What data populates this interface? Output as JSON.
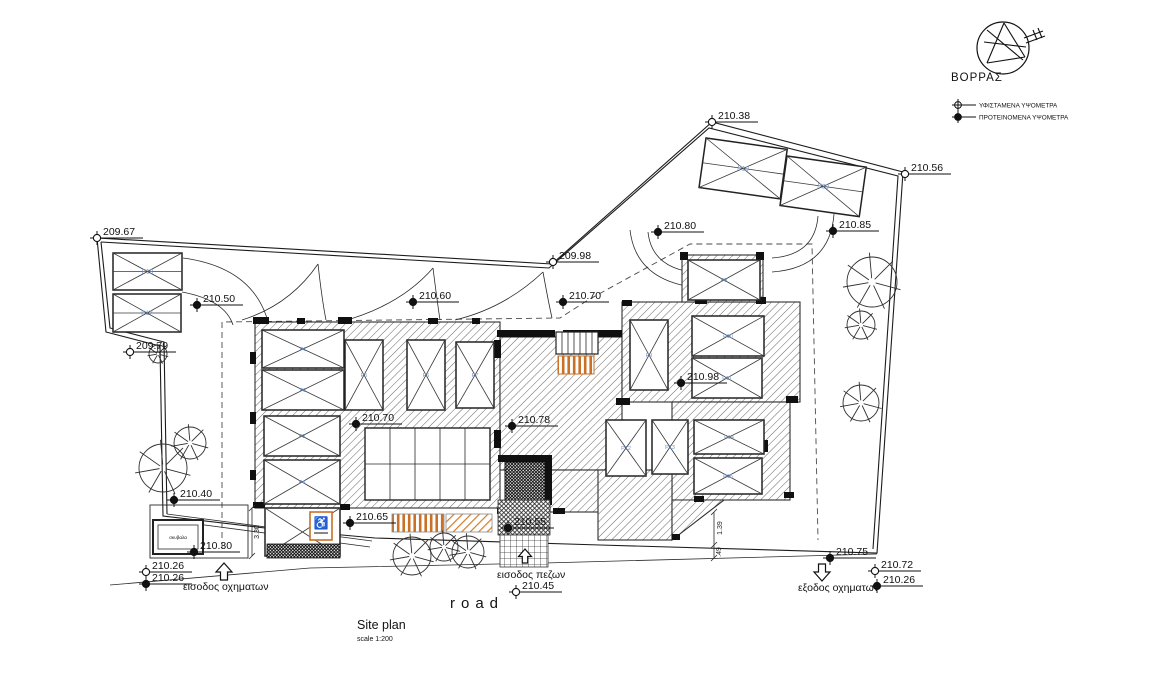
{
  "canvas": {
    "background": "#ffffff",
    "ink": "#1c1c1c",
    "parking_label_blue": "#6b93cf",
    "ramp_orange": "#c87127"
  },
  "title": {
    "name": "Site plan",
    "scale": "scale 1:200"
  },
  "road_label": "road",
  "compass_label": "ΒΟΡΡΑΣ",
  "legend": {
    "existing": "ΥΦΙΣΤΑΜΕΝΑ ΥΨΟΜΕΤΡΑ",
    "proposed": "ΠΡΟΤΕΙΝΟΜΕΝΑ ΥΨΟΜΕΤΡΑ"
  },
  "annotations": {
    "vehicle_entrance": "εισοδος οχηματων",
    "pedestrian_entrance": "εισοδος πεζων",
    "vehicle_exit": "εξοδος οχηματων",
    "bin": "σκυβαλα",
    "accessible_symbol": "♿"
  },
  "elevations": [
    {
      "value": "209.67",
      "type": "existing",
      "x": 97,
      "y": 238
    },
    {
      "value": "210.38",
      "type": "existing",
      "x": 712,
      "y": 122
    },
    {
      "value": "210.56",
      "type": "existing",
      "x": 905,
      "y": 174
    },
    {
      "value": "209.98",
      "type": "existing",
      "x": 553,
      "y": 262
    },
    {
      "value": "210.80",
      "type": "proposed",
      "x": 658,
      "y": 232
    },
    {
      "value": "210.85",
      "type": "proposed",
      "x": 833,
      "y": 231
    },
    {
      "value": "210.50",
      "type": "proposed",
      "x": 197,
      "y": 305
    },
    {
      "value": "210.60",
      "type": "proposed",
      "x": 413,
      "y": 302
    },
    {
      "value": "210.70",
      "type": "proposed",
      "x": 563,
      "y": 302
    },
    {
      "value": "209.79",
      "type": "existing",
      "x": 130,
      "y": 352
    },
    {
      "value": "210.70",
      "type": "proposed",
      "x": 356,
      "y": 424
    },
    {
      "value": "210.78",
      "type": "proposed",
      "x": 512,
      "y": 426
    },
    {
      "value": "210.98",
      "type": "proposed",
      "x": 681,
      "y": 383
    },
    {
      "value": "210.40",
      "type": "proposed",
      "x": 174,
      "y": 500
    },
    {
      "value": "210.30",
      "type": "proposed",
      "x": 194,
      "y": 552
    },
    {
      "value": "210.26",
      "type": "existing",
      "x": 146,
      "y": 572
    },
    {
      "value": "210.26",
      "type": "proposed",
      "x": 146,
      "y": 584
    },
    {
      "value": "210.65",
      "type": "proposed",
      "x": 350,
      "y": 523
    },
    {
      "value": "210.55",
      "type": "proposed",
      "x": 508,
      "y": 528
    },
    {
      "value": "210.45",
      "type": "existing",
      "x": 516,
      "y": 592
    },
    {
      "value": "210.75",
      "type": "proposed",
      "x": 830,
      "y": 558
    },
    {
      "value": "210.72",
      "type": "existing",
      "x": 875,
      "y": 571
    },
    {
      "value": "210.26",
      "type": "proposed",
      "x": 877,
      "y": 586
    }
  ],
  "dimensions": [
    {
      "value": "3.30",
      "x": 259,
      "y": 532
    },
    {
      "value": "1.39",
      "x": 722,
      "y": 528
    },
    {
      "value": ".49",
      "x": 721,
      "y": 552
    }
  ],
  "parking": {
    "exterior": [
      {
        "label": "P18",
        "x": 113,
        "y": 253,
        "w": 69,
        "h": 37,
        "rot": 0
      },
      {
        "label": "P17",
        "x": 113,
        "y": 294,
        "w": 68,
        "h": 38,
        "rot": 0
      },
      {
        "label": "P19",
        "x": 706,
        "y": 138,
        "w": 82,
        "h": 50,
        "rot": 8
      },
      {
        "label": "P20",
        "x": 787,
        "y": 156,
        "w": 80,
        "h": 50,
        "rot": 8
      }
    ],
    "interior": [
      {
        "label": "P1",
        "x": 262,
        "y": 330,
        "w": 82,
        "h": 38
      },
      {
        "label": "P2",
        "x": 262,
        "y": 370,
        "w": 82,
        "h": 40
      },
      {
        "label": "P3",
        "x": 264,
        "y": 416,
        "w": 76,
        "h": 40
      },
      {
        "label": "P4",
        "x": 264,
        "y": 460,
        "w": 76,
        "h": 44
      },
      {
        "label": "P5",
        "x": 345,
        "y": 340,
        "w": 38,
        "h": 70
      },
      {
        "label": "P6",
        "x": 407,
        "y": 340,
        "w": 38,
        "h": 70
      },
      {
        "label": "P7",
        "x": 456,
        "y": 342,
        "w": 38,
        "h": 66
      },
      {
        "label": "P8",
        "x": 688,
        "y": 260,
        "w": 72,
        "h": 40
      },
      {
        "label": "P9",
        "x": 630,
        "y": 320,
        "w": 38,
        "h": 70
      },
      {
        "label": "P10",
        "x": 692,
        "y": 316,
        "w": 72,
        "h": 40
      },
      {
        "label": "P11",
        "x": 692,
        "y": 358,
        "w": 70,
        "h": 40
      },
      {
        "label": "P12",
        "x": 606,
        "y": 420,
        "w": 40,
        "h": 56
      },
      {
        "label": "P13",
        "x": 652,
        "y": 420,
        "w": 36,
        "h": 54
      },
      {
        "label": "P14",
        "x": 694,
        "y": 420,
        "w": 70,
        "h": 34
      },
      {
        "label": "P15",
        "x": 694,
        "y": 458,
        "w": 68,
        "h": 36
      }
    ]
  },
  "trees": [
    {
      "x": 163,
      "y": 468,
      "r": 24
    },
    {
      "x": 190,
      "y": 443,
      "r": 16
    },
    {
      "x": 158,
      "y": 354,
      "r": 9
    },
    {
      "x": 412,
      "y": 556,
      "r": 19
    },
    {
      "x": 444,
      "y": 547,
      "r": 14
    },
    {
      "x": 468,
      "y": 552,
      "r": 16
    },
    {
      "x": 872,
      "y": 282,
      "r": 25
    },
    {
      "x": 861,
      "y": 325,
      "r": 14
    },
    {
      "x": 861,
      "y": 403,
      "r": 18
    }
  ]
}
